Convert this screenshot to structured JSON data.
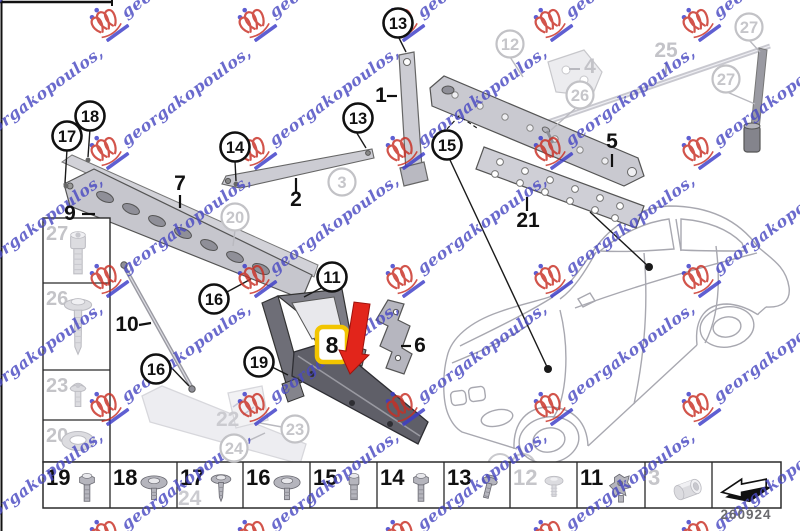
{
  "page": {
    "code": "260924",
    "background": "#ffffff"
  },
  "watermark": {
    "text": "georgakopoulos,",
    "text_color": "#4a4ac2",
    "crest_color": "#c82f24",
    "accent_color": "#3c3cc8",
    "angle": -36,
    "cols": [
      -48,
      100,
      248,
      396,
      544,
      692
    ],
    "rows": [
      30,
      158,
      286,
      414,
      542
    ]
  },
  "highlight": {
    "n": "8",
    "box_color": "#f2c500",
    "arrow_color": "#e2251b"
  },
  "callouts": [
    {
      "n": "13",
      "x": 398,
      "y": 23,
      "style": "bold"
    },
    {
      "n": "18",
      "x": 90,
      "y": 116,
      "style": "bold"
    },
    {
      "n": "17",
      "x": 67,
      "y": 136,
      "style": "bold"
    },
    {
      "n": "14",
      "x": 235,
      "y": 147,
      "style": "bold"
    },
    {
      "n": "13",
      "x": 358,
      "y": 118,
      "style": "bold"
    },
    {
      "n": "15",
      "x": 447,
      "y": 145,
      "style": "bold"
    },
    {
      "n": "11",
      "x": 332,
      "y": 277,
      "style": "bold"
    },
    {
      "n": "16",
      "x": 214,
      "y": 299,
      "style": "bold"
    },
    {
      "n": "16",
      "x": 156,
      "y": 369,
      "style": "bold"
    },
    {
      "n": "19",
      "x": 259,
      "y": 362,
      "style": "bold"
    },
    {
      "n": "20",
      "x": 235,
      "y": 217,
      "style": "faded"
    },
    {
      "n": "3",
      "x": 342,
      "y": 182,
      "style": "faded"
    },
    {
      "n": "12",
      "x": 510,
      "y": 44,
      "style": "faded"
    },
    {
      "n": "26",
      "x": 580,
      "y": 95,
      "style": "faded"
    },
    {
      "n": "27",
      "x": 749,
      "y": 27,
      "style": "faded"
    },
    {
      "n": "27",
      "x": 726,
      "y": 79,
      "style": "faded"
    },
    {
      "n": "23",
      "x": 295,
      "y": 429,
      "style": "faded"
    },
    {
      "n": "24",
      "x": 234,
      "y": 448,
      "style": "faded"
    }
  ],
  "part_labels": [
    {
      "n": "1",
      "x": 381,
      "y": 102,
      "style": "bold"
    },
    {
      "n": "2",
      "x": 296,
      "y": 206,
      "style": "bold"
    },
    {
      "n": "7",
      "x": 180,
      "y": 190,
      "style": "bold"
    },
    {
      "n": "9",
      "x": 70,
      "y": 220,
      "style": "bold"
    },
    {
      "n": "5",
      "x": 612,
      "y": 148,
      "style": "bold"
    },
    {
      "n": "21",
      "x": 528,
      "y": 227,
      "style": "bold"
    },
    {
      "n": "10",
      "x": 127,
      "y": 331,
      "style": "bold"
    },
    {
      "n": "6",
      "x": 420,
      "y": 352,
      "style": "bold"
    },
    {
      "n": "25",
      "x": 666,
      "y": 57,
      "style": "faded"
    },
    {
      "n": "4",
      "x": 590,
      "y": 73,
      "style": "faded"
    }
  ],
  "ghost_labels": [
    {
      "n": "22",
      "x": 216,
      "y": 426
    },
    {
      "n": "24",
      "x": 178,
      "y": 505
    }
  ],
  "left_column": {
    "cells": [
      {
        "n": "27",
        "icon": "socket-screw"
      },
      {
        "n": "26",
        "icon": "long-screw"
      },
      {
        "n": "23",
        "icon": "button-screw"
      },
      {
        "n": "20",
        "icon": "washer"
      }
    ]
  },
  "bottom_row": {
    "cells": [
      {
        "n": "19",
        "icon": "hex-bolt",
        "faded": false
      },
      {
        "n": "18",
        "icon": "dome-screw",
        "faded": false
      },
      {
        "n": "17",
        "icon": "washer-screw",
        "faded": false
      },
      {
        "n": "16",
        "icon": "dome-screw",
        "faded": false
      },
      {
        "n": "15",
        "icon": "cyl-bolt",
        "faded": false
      },
      {
        "n": "14",
        "icon": "hex-bolt",
        "faded": false
      },
      {
        "n": "13",
        "icon": "flange-bolt",
        "faded": false
      },
      {
        "n": "12",
        "icon": "push-rivet",
        "faded": true
      },
      {
        "n": "11",
        "icon": "clip-nut",
        "faded": false
      },
      {
        "n": "3",
        "icon": "barrel-nut",
        "faded": true
      },
      {
        "n": "",
        "icon": "direction-arrow",
        "faded": false
      }
    ]
  }
}
